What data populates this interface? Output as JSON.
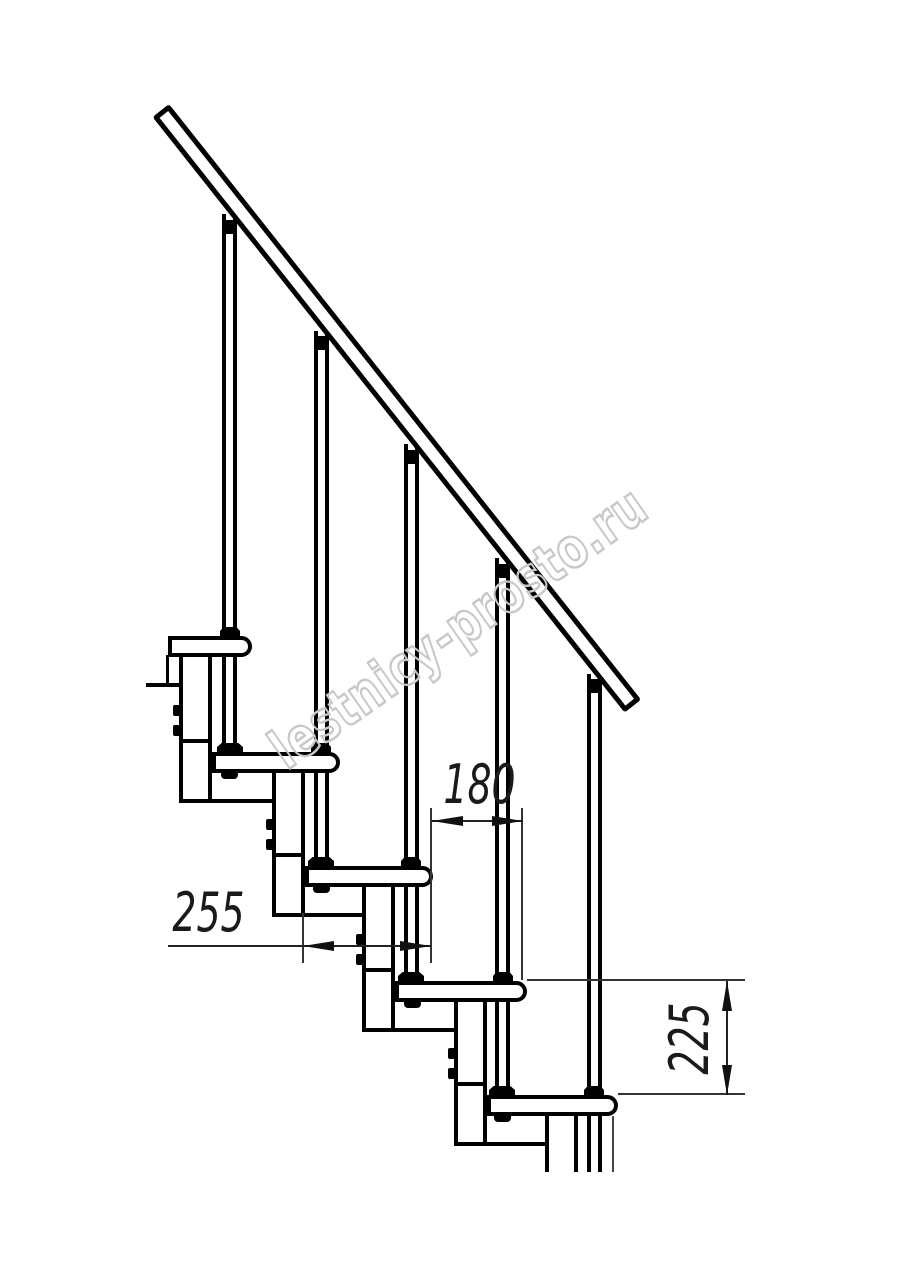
{
  "watermark": {
    "text": "lestnicy-prosto.ru"
  },
  "dimensions": {
    "dim_180": "180",
    "dim_255": "255",
    "dim_225": "225"
  },
  "colors": {
    "drawing_line": "#000000",
    "dimension_line": "#222222",
    "watermark_outline": "#c8c8c8"
  }
}
